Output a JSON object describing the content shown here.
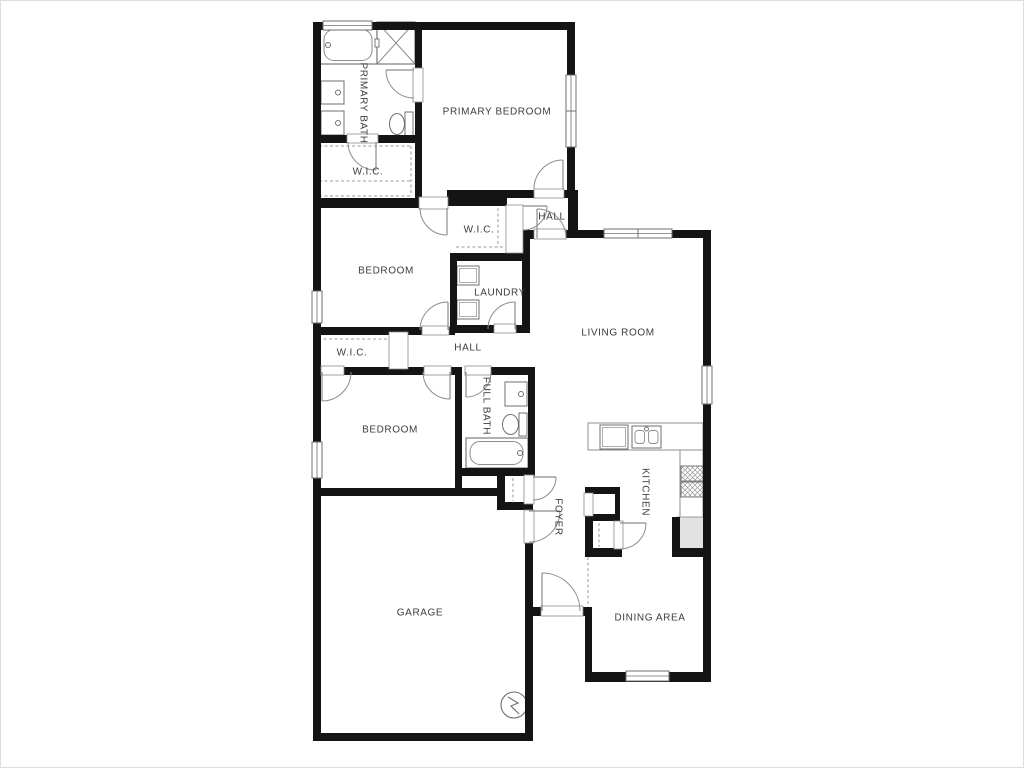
{
  "plan": {
    "colors": {
      "wall": "#141414",
      "line": "#6f6f6f",
      "thin": "#8c8c8c",
      "dash": "#9a9a9a",
      "label": "#3c3c3c",
      "fridge_fill": "#e2e2e2",
      "paper": "#ffffff"
    },
    "rooms": [
      {
        "id": "primary-bath",
        "label": "PRIMARY BATH",
        "cx": 363,
        "cy": 103,
        "vertical": true
      },
      {
        "id": "primary-wic",
        "label": "W.I.C.",
        "cx": 368,
        "cy": 172,
        "vertical": false
      },
      {
        "id": "primary-bedroom",
        "label": "PRIMARY BEDROOM",
        "cx": 497,
        "cy": 112,
        "vertical": false
      },
      {
        "id": "hall-upper",
        "label": "HALL",
        "cx": 552,
        "cy": 217,
        "vertical": false
      },
      {
        "id": "hall-closet",
        "label": "W.I.C.",
        "cx": 479,
        "cy": 230,
        "vertical": false
      },
      {
        "id": "bedroom-1",
        "label": "BEDROOM",
        "cx": 386,
        "cy": 271,
        "vertical": false
      },
      {
        "id": "laundry",
        "label": "LAUNDRY",
        "cx": 500,
        "cy": 293,
        "vertical": false
      },
      {
        "id": "hall-lower",
        "label": "HALL",
        "cx": 468,
        "cy": 348,
        "vertical": false
      },
      {
        "id": "bedroom2-wic",
        "label": "W.I.C.",
        "cx": 352,
        "cy": 353,
        "vertical": false
      },
      {
        "id": "bedroom-2",
        "label": "BEDROOM",
        "cx": 390,
        "cy": 430,
        "vertical": false
      },
      {
        "id": "full-bath",
        "label": "FULL BATH",
        "cx": 486,
        "cy": 406,
        "vertical": true
      },
      {
        "id": "living-room",
        "label": "LIVING ROOM",
        "cx": 618,
        "cy": 333,
        "vertical": false
      },
      {
        "id": "kitchen",
        "label": "KITCHEN",
        "cx": 645,
        "cy": 492,
        "vertical": true
      },
      {
        "id": "foyer",
        "label": "FOYER",
        "cx": 558,
        "cy": 517,
        "vertical": true
      },
      {
        "id": "garage",
        "label": "GARAGE",
        "cx": 420,
        "cy": 613,
        "vertical": false
      },
      {
        "id": "dining-area",
        "label": "DINING AREA",
        "cx": 650,
        "cy": 618,
        "vertical": false
      }
    ],
    "walls": [
      [
        313,
        22,
        262,
        8
      ],
      [
        313,
        22,
        8,
        719
      ],
      [
        567,
        22,
        8,
        170
      ],
      [
        415,
        30,
        7,
        168
      ],
      [
        313,
        135,
        102,
        8
      ],
      [
        313,
        198,
        107,
        10
      ],
      [
        415,
        190,
        5,
        8
      ],
      [
        447,
        190,
        88,
        8
      ],
      [
        447,
        198,
        60,
        8
      ],
      [
        563,
        190,
        15,
        8
      ],
      [
        568,
        196,
        10,
        36
      ],
      [
        565,
        230,
        146,
        8
      ],
      [
        703,
        238,
        8,
        444
      ],
      [
        520,
        230,
        15,
        9
      ],
      [
        522,
        239,
        8,
        94
      ],
      [
        450,
        253,
        80,
        8
      ],
      [
        450,
        253,
        7,
        80
      ],
      [
        450,
        325,
        45,
        8
      ],
      [
        515,
        325,
        15,
        8
      ],
      [
        313,
        327,
        110,
        8
      ],
      [
        448,
        327,
        7,
        8
      ],
      [
        313,
        367,
        9,
        8
      ],
      [
        343,
        367,
        82,
        8
      ],
      [
        450,
        367,
        12,
        8
      ],
      [
        455,
        367,
        7,
        121
      ],
      [
        490,
        367,
        45,
        8
      ],
      [
        528,
        375,
        7,
        93
      ],
      [
        455,
        468,
        80,
        8
      ],
      [
        313,
        488,
        192,
        8
      ],
      [
        497,
        468,
        8,
        40
      ],
      [
        497,
        502,
        36,
        8
      ],
      [
        525,
        503,
        8,
        9
      ],
      [
        525,
        542,
        8,
        199
      ],
      [
        313,
        733,
        220,
        8
      ],
      [
        533,
        607,
        59,
        9
      ],
      [
        585,
        607,
        7,
        75
      ],
      [
        585,
        672,
        126,
        10
      ],
      [
        585,
        487,
        8,
        70
      ],
      [
        585,
        487,
        35,
        7
      ],
      [
        585,
        514,
        35,
        7
      ],
      [
        585,
        548,
        37,
        9
      ],
      [
        615,
        487,
        5,
        30
      ],
      [
        672,
        517,
        8,
        40
      ],
      [
        672,
        548,
        39,
        9
      ]
    ],
    "windows": [
      {
        "x": 323,
        "y": 21,
        "w": 49,
        "h": 9,
        "orient": "h",
        "panes": 1
      },
      {
        "x": 566,
        "y": 75,
        "w": 10,
        "h": 72,
        "orient": "v",
        "panes": 2
      },
      {
        "x": 604,
        "y": 229,
        "w": 68,
        "h": 9,
        "orient": "h",
        "panes": 2
      },
      {
        "x": 702,
        "y": 366,
        "w": 10,
        "h": 38,
        "orient": "v",
        "panes": 1
      },
      {
        "x": 312,
        "y": 291,
        "w": 10,
        "h": 32,
        "orient": "v",
        "panes": 1
      },
      {
        "x": 312,
        "y": 442,
        "w": 10,
        "h": 36,
        "orient": "v",
        "panes": 1
      },
      {
        "x": 626,
        "y": 671,
        "w": 43,
        "h": 10,
        "orient": "h",
        "panes": 1
      }
    ],
    "frames": [
      [
        413,
        68,
        10,
        34
      ],
      [
        347,
        134,
        31,
        9
      ],
      [
        534,
        189,
        30,
        9
      ],
      [
        419,
        197,
        29,
        12
      ],
      [
        506,
        205,
        17,
        48
      ],
      [
        534,
        229,
        32,
        10
      ],
      [
        494,
        324,
        22,
        9
      ],
      [
        422,
        326,
        27,
        9
      ],
      [
        389,
        332,
        19,
        37
      ],
      [
        321,
        366,
        23,
        9
      ],
      [
        424,
        366,
        27,
        9
      ],
      [
        465,
        366,
        26,
        9
      ],
      [
        524,
        510,
        10,
        33
      ],
      [
        524,
        475,
        10,
        29
      ],
      [
        541,
        606,
        42,
        10
      ],
      [
        584,
        493,
        9,
        23
      ],
      [
        614,
        521,
        9,
        28
      ]
    ],
    "doors": [
      {
        "hinge": [
          414,
          70
        ],
        "leaf": [
          -1,
          0
        ],
        "jamb": [
          0,
          1
        ],
        "r": 28
      },
      {
        "hinge": [
          376,
          142
        ],
        "leaf": [
          0,
          1
        ],
        "jamb": [
          -1,
          0
        ],
        "r": 28
      },
      {
        "hinge": [
          563,
          189
        ],
        "leaf": [
          0,
          -1
        ],
        "jamb": [
          -1,
          0
        ],
        "r": 29
      },
      {
        "hinge": [
          447,
          208
        ],
        "leaf": [
          0,
          1
        ],
        "jamb": [
          -1,
          0
        ],
        "r": 27
      },
      {
        "hinge": [
          523,
          206
        ],
        "leaf": [
          1,
          0
        ],
        "jamb": [
          0,
          1
        ],
        "r": 24
      },
      {
        "hinge": [
          537,
          238
        ],
        "leaf": [
          0,
          -1
        ],
        "jamb": [
          1,
          0
        ],
        "r": 29
      },
      {
        "hinge": [
          515,
          329
        ],
        "leaf": [
          0,
          -1
        ],
        "jamb": [
          -1,
          0
        ],
        "r": 27
      },
      {
        "hinge": [
          448,
          330
        ],
        "leaf": [
          0,
          -1
        ],
        "jamb": [
          -1,
          0
        ],
        "r": 28
      },
      {
        "hinge": [
          322,
          372
        ],
        "leaf": [
          0,
          1
        ],
        "jamb": [
          1,
          0
        ],
        "r": 29
      },
      {
        "hinge": [
          450,
          372
        ],
        "leaf": [
          0,
          1
        ],
        "jamb": [
          -1,
          0
        ],
        "r": 27
      },
      {
        "hinge": [
          466,
          372
        ],
        "leaf": [
          0,
          1
        ],
        "jamb": [
          1,
          0
        ],
        "r": 25
      },
      {
        "hinge": [
          529,
          511
        ],
        "leaf": [
          1,
          0
        ],
        "jamb": [
          0,
          1
        ],
        "r": 31
      },
      {
        "hinge": [
          533,
          477
        ],
        "leaf": [
          1,
          0
        ],
        "jamb": [
          0,
          1
        ],
        "r": 23
      },
      {
        "hinge": [
          542,
          611
        ],
        "leaf": [
          0,
          -1
        ],
        "jamb": [
          1,
          0
        ],
        "r": 38
      },
      {
        "hinge": [
          620,
          523
        ],
        "leaf": [
          1,
          0
        ],
        "jamb": [
          0,
          1
        ],
        "r": 26
      }
    ],
    "dashes": [
      {
        "x1": 319,
        "y1": 146,
        "x2": 411,
        "y2": 146
      },
      {
        "x1": 319,
        "y1": 146,
        "x2": 319,
        "y2": 196
      },
      {
        "x1": 411,
        "y1": 146,
        "x2": 411,
        "y2": 196
      },
      {
        "x1": 319,
        "y1": 181,
        "x2": 411,
        "y2": 181
      },
      {
        "x1": 319,
        "y1": 196,
        "x2": 411,
        "y2": 196
      },
      {
        "x1": 456,
        "y1": 247,
        "x2": 505,
        "y2": 247
      },
      {
        "x1": 498,
        "y1": 208,
        "x2": 498,
        "y2": 247
      },
      {
        "x1": 318,
        "y1": 339,
        "x2": 389,
        "y2": 339
      },
      {
        "x1": 513,
        "y1": 478,
        "x2": 513,
        "y2": 501
      },
      {
        "x1": 594,
        "y1": 492,
        "x2": 614,
        "y2": 492
      },
      {
        "x1": 599,
        "y1": 523,
        "x2": 599,
        "y2": 547
      },
      {
        "x1": 590,
        "y1": 427,
        "x2": 676,
        "y2": 427
      },
      {
        "x1": 692,
        "y1": 455,
        "x2": 692,
        "y2": 545
      },
      {
        "x1": 588,
        "y1": 557,
        "x2": 588,
        "y2": 607
      }
    ],
    "fixtures": [
      {
        "type": "counter",
        "x": 588,
        "y": 423,
        "w": 115,
        "h": 27
      },
      {
        "type": "counter",
        "x": 680,
        "y": 450,
        "w": 23,
        "h": 98
      },
      {
        "type": "tub",
        "x": 320,
        "y": 26,
        "w": 57,
        "h": 38,
        "faucet": "left"
      },
      {
        "type": "shower",
        "x": 377,
        "y": 22,
        "w": 38,
        "h": 42
      },
      {
        "type": "sink",
        "x": 321,
        "y": 81,
        "w": 23,
        "h": 23,
        "faucet": "right"
      },
      {
        "type": "sink",
        "x": 321,
        "y": 111,
        "w": 23,
        "h": 24,
        "faucet": "right"
      },
      {
        "type": "toilet",
        "x": 389,
        "y": 112,
        "w": 24,
        "h": 24
      },
      {
        "type": "appliance",
        "x": 457,
        "y": 266,
        "w": 22,
        "h": 19
      },
      {
        "type": "appliance",
        "x": 457,
        "y": 300,
        "w": 22,
        "h": 19
      },
      {
        "type": "sink",
        "x": 505,
        "y": 382,
        "w": 22,
        "h": 24,
        "faucet": "right"
      },
      {
        "type": "toilet",
        "x": 502,
        "y": 413,
        "w": 25,
        "h": 23
      },
      {
        "type": "tub",
        "x": 466,
        "y": 438,
        "w": 62,
        "h": 30,
        "faucet": "right"
      },
      {
        "type": "appliance",
        "x": 600,
        "y": 425,
        "w": 28,
        "h": 24
      },
      {
        "type": "dblsink",
        "x": 632,
        "y": 426,
        "w": 29,
        "h": 22
      },
      {
        "type": "stove",
        "x": 681,
        "y": 466,
        "w": 22,
        "h": 31
      },
      {
        "type": "fridge",
        "x": 677,
        "y": 517,
        "w": 30,
        "h": 34
      },
      {
        "type": "heater",
        "cx": 514,
        "cy": 705,
        "r": 13
      },
      {
        "type": "gdoor",
        "x": 333,
        "y": 734,
        "w": 184,
        "h": 7
      }
    ]
  }
}
